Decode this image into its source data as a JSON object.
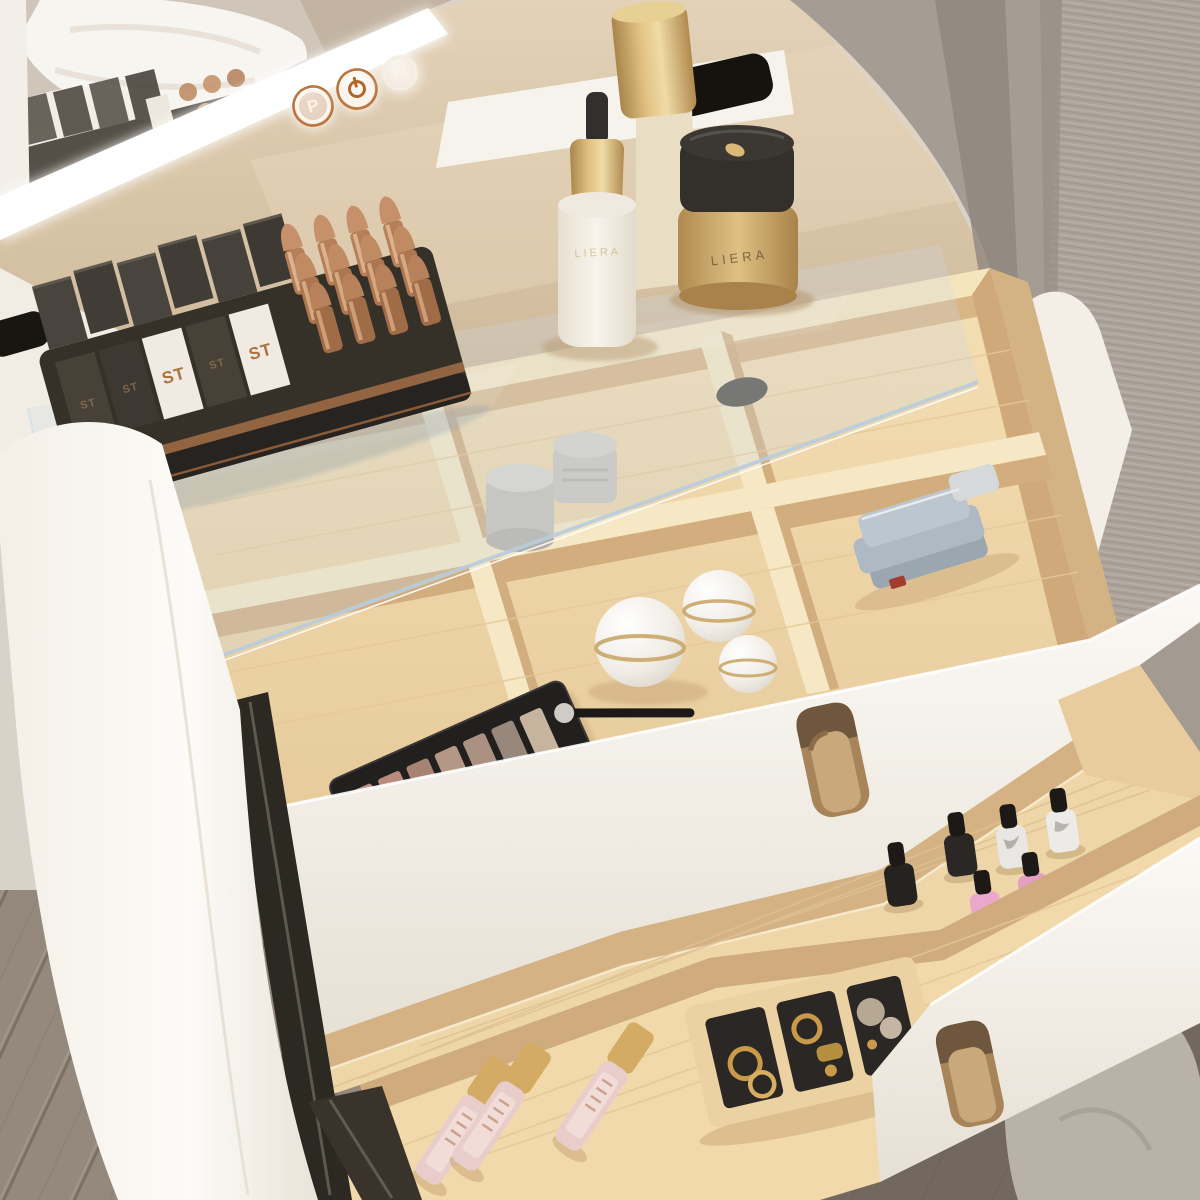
{
  "scene": {
    "title": "White dressing table with LED mirror, glass-top cosmetic organizer and open wooden makeup drawers",
    "description": "Overhead corner view of a white vanity: a lighted mirror with touch controls reflects white bedding; a tempered glass sheet covers a six-compartment pine organizer filled with cosmetics; two pulled-out pine drawers hold nail polish bottles, a sectioned jewelry tray and lip gloss tubes. A grey curtain hangs at the right and grey wood flooring shows at the bottom."
  },
  "labels": {
    "lipstick_box": "ST",
    "brand": "LIERA"
  },
  "mirror": {
    "led_color": "#ffffff",
    "buttons": [
      {
        "label": "P",
        "ring_color": "#b4662a"
      },
      {
        "icon": "power-icon",
        "ring_color": "#b4662a"
      },
      {
        "label": "M",
        "ring_color": "#f5efe2"
      }
    ]
  },
  "palette_pans": [
    "#c09184",
    "#b98a7d",
    "#a88273",
    "#b59785",
    "#ab9181",
    "#98887c",
    "#c7b49f"
  ],
  "nail_polish_bodies": [
    "#26221f",
    "#2b2724",
    "#e9e7e3",
    "#edebe7",
    "#eba8cb",
    "#e39ec2"
  ],
  "lip_gloss": {
    "body": "#e9cdca",
    "cap": "#d4ab64"
  },
  "colors": {
    "furniture_white": "#f7f4ee",
    "pine_light": "#f2dcb0",
    "pine_shadow": "#cfab7e",
    "glass_tint": "#cdd9e4",
    "curtain_grey": "#a59c93",
    "curtain_hem": "#b9b2a9",
    "floor_grey": "#95897d",
    "rose_gold": "#bf8a66",
    "tray_black": "#34302c",
    "gold": "#c9a668",
    "felt_black": "#2b2724",
    "polish_cap": "#1c1916"
  },
  "counts": {
    "organizer_compartments": 6,
    "lipstick_bullets": 12,
    "lipstick_boxes": 11,
    "nail_polishes": 6,
    "ball_jars": 3,
    "grey_jars": 2,
    "lip_glosses": 3,
    "jewelry_sections": 3,
    "mirror_buttons": 3,
    "drawers_open": 2
  }
}
